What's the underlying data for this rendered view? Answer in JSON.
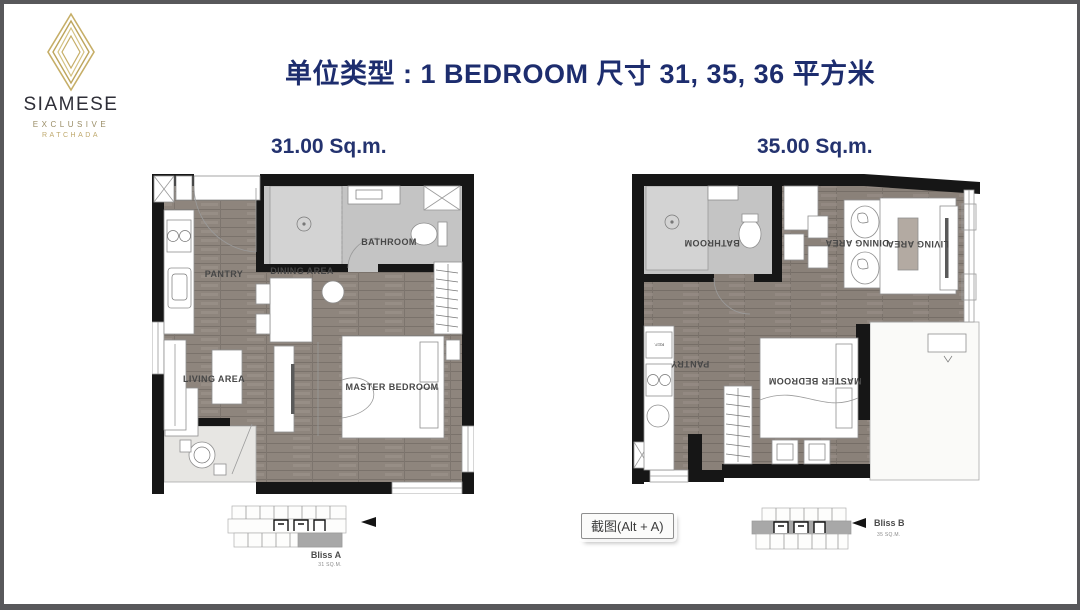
{
  "logo": {
    "brand": "SIAMESE",
    "subtitle": "EXCLUSIVE",
    "location": "RATCHADA"
  },
  "header": {
    "title": "单位类型 : 1 BEDROOM  尺寸 31, 35, 36 平方米"
  },
  "plan_a": {
    "size_label": "31.00 Sq.m.",
    "rooms": {
      "pantry": "PANTRY",
      "dining": "DINING AREA",
      "bathroom": "BATHROOM",
      "living": "LIVING AREA",
      "bedroom": "MASTER BEDROOM"
    },
    "fridge_label": "REF.",
    "keyplan": {
      "name": "Bliss A",
      "area": "31 SQ.M."
    }
  },
  "plan_b": {
    "size_label": "35.00 Sq.m.",
    "rooms": {
      "pantry": "PANTRY",
      "dining": "DINING AREA",
      "bathroom": "BATHROOM",
      "living": "LIVING AREA",
      "bedroom": "MASTER BEDROOM"
    },
    "fridge_label": "REF.",
    "keyplan": {
      "name": "Bliss B",
      "area": "35 SQ.M."
    }
  },
  "tooltip": {
    "label": "截图(Alt + A)"
  },
  "colors": {
    "frame_border": "#58585b",
    "title_navy": "#1d2d6e",
    "logo_gold": "#c6ae67",
    "wall_black": "#161616",
    "wood_floor": "#8e857d",
    "bathroom_tile": "#c4c4c4",
    "balcony_grey": "#e7e6e3",
    "keyplan_highlight": "#a8a8a8"
  }
}
